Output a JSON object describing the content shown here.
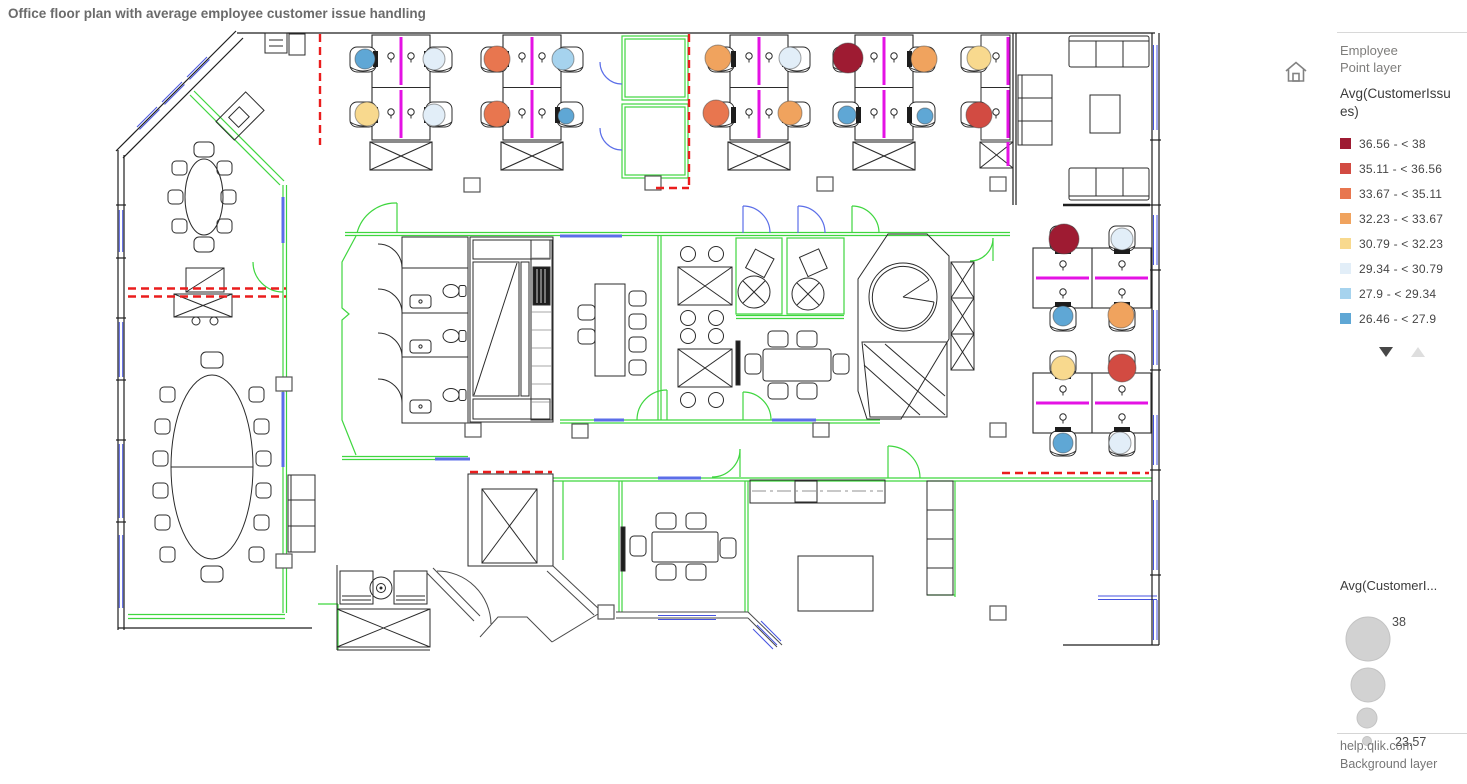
{
  "title": "Office floor plan with average employee customer issue handling",
  "icons": {
    "home": "home-icon",
    "scroll_down": "triangle-down-icon",
    "scroll_up": "triangle-up-icon"
  },
  "legend": {
    "layer_name": "Employee",
    "layer_type": "Point layer",
    "measure_title": "Avg(CustomerIssues)"
  },
  "size_legend": {
    "title": "Avg(CustomerI...",
    "max_label": "38",
    "min_label": "23.57"
  },
  "attribution": {
    "link": "help.qlik.com",
    "layer_label": "Background layer"
  },
  "chart_data": {
    "type": "scatter",
    "subtype": "map-point-layer-on-floorplan",
    "title": "Office floor plan with average employee customer issue handling",
    "measure": "Avg(CustomerIssues)",
    "layers": [
      "Point layer",
      "Background layer"
    ],
    "size_range": {
      "min": 23.57,
      "max": 38
    },
    "legend_position": "right",
    "color_classes": [
      {
        "label": "36.56 - < 38",
        "color": "#9e1b32"
      },
      {
        "label": "35.11 - < 36.56",
        "color": "#d24b42"
      },
      {
        "label": "33.67 - < 35.11",
        "color": "#e8764f"
      },
      {
        "label": "32.23 - < 33.67",
        "color": "#f0a35e"
      },
      {
        "label": "30.79 - < 32.23",
        "color": "#f8d98e"
      },
      {
        "label": "29.34 - < 30.79",
        "color": "#e2eef8"
      },
      {
        "label": "27.9 - < 29.34",
        "color": "#a6d3ee"
      },
      {
        "label": "26.46 - < 27.9",
        "color": "#5fa7d5"
      }
    ],
    "points": [
      {
        "x": 365,
        "y": 59,
        "r": 10,
        "class": 7
      },
      {
        "x": 434,
        "y": 59,
        "r": 11,
        "class": 5
      },
      {
        "x": 367,
        "y": 114,
        "r": 12,
        "class": 4
      },
      {
        "x": 434,
        "y": 115,
        "r": 11,
        "class": 5
      },
      {
        "x": 497,
        "y": 59,
        "r": 13,
        "class": 2
      },
      {
        "x": 563,
        "y": 59,
        "r": 11,
        "class": 6
      },
      {
        "x": 497,
        "y": 114,
        "r": 13,
        "class": 2
      },
      {
        "x": 566,
        "y": 116,
        "r": 8,
        "class": 7
      },
      {
        "x": 718,
        "y": 58,
        "r": 13,
        "class": 3
      },
      {
        "x": 790,
        "y": 58,
        "r": 11,
        "class": 5
      },
      {
        "x": 716,
        "y": 113,
        "r": 13,
        "class": 2
      },
      {
        "x": 790,
        "y": 113,
        "r": 12,
        "class": 3
      },
      {
        "x": 848,
        "y": 58,
        "r": 15,
        "class": 0
      },
      {
        "x": 924,
        "y": 59,
        "r": 13,
        "class": 3
      },
      {
        "x": 847,
        "y": 115,
        "r": 9,
        "class": 7
      },
      {
        "x": 925,
        "y": 116,
        "r": 8,
        "class": 7
      },
      {
        "x": 979,
        "y": 58,
        "r": 12,
        "class": 4
      },
      {
        "x": 979,
        "y": 115,
        "r": 13,
        "class": 1
      },
      {
        "x": 1064,
        "y": 239,
        "r": 15,
        "class": 0
      },
      {
        "x": 1122,
        "y": 239,
        "r": 11,
        "class": 5
      },
      {
        "x": 1063,
        "y": 316,
        "r": 10,
        "class": 7
      },
      {
        "x": 1121,
        "y": 315,
        "r": 13,
        "class": 3
      },
      {
        "x": 1063,
        "y": 368,
        "r": 12,
        "class": 4
      },
      {
        "x": 1122,
        "y": 368,
        "r": 14,
        "class": 1
      },
      {
        "x": 1063,
        "y": 443,
        "r": 10,
        "class": 7
      },
      {
        "x": 1120,
        "y": 443,
        "r": 11,
        "class": 5
      }
    ]
  }
}
